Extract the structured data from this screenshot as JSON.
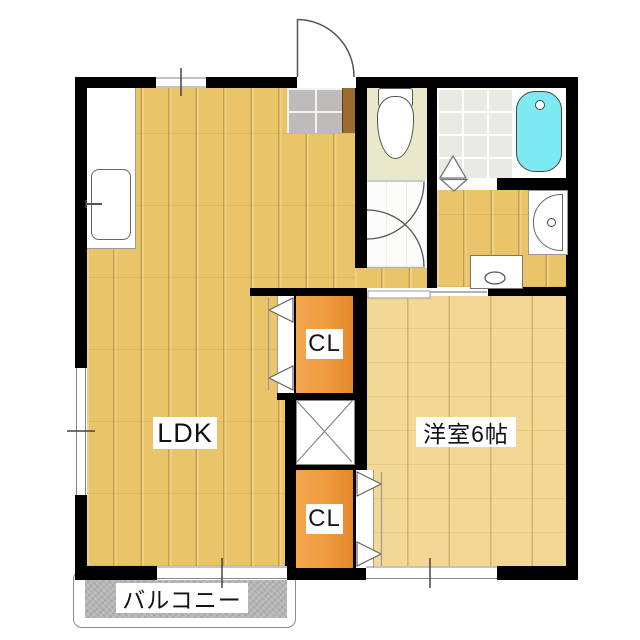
{
  "plan": {
    "type": "apartment-floor-plan",
    "rooms": {
      "ldk": {
        "label": "LDK"
      },
      "western_room": {
        "label": "洋室6帖"
      },
      "closet_upper": {
        "label": "CL"
      },
      "closet_lower": {
        "label": "CL"
      },
      "balcony": {
        "label": "バルコニー"
      }
    },
    "fixtures": [
      "kitchen-sink",
      "toilet",
      "bathtub",
      "washbasin",
      "washing-machine-pan",
      "pipe-shaft",
      "entrance-door",
      "genkan-tiles",
      "bifold-closet-doors",
      "sliding-window"
    ],
    "colors": {
      "wall": "#000000",
      "ldk_floor": "#eac468",
      "western_floor": "#f2d795",
      "hallway_floor": "#fbfbf9",
      "toilet_floor": "#eae8cb",
      "bath_tile": "#eaeae4",
      "genkan_tile": "#bdbcba",
      "genkan_step": "#9a6a33",
      "closet": "#ef9a3e",
      "bathtub": "#7de9f0",
      "balcony": "#b4b4b4",
      "label_bg": "#ffffff",
      "label_text": "#111111"
    }
  }
}
